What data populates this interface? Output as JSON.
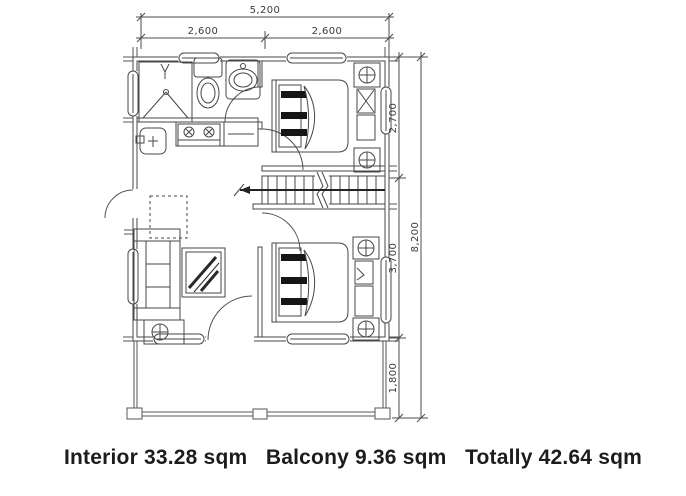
{
  "plan": {
    "dim_top_total": "5,200",
    "dim_top_left": "2,600",
    "dim_top_right": "2,600",
    "dim_right_upper": "2,700",
    "dim_right_middle": "3,700",
    "dim_right_lower": "1,800",
    "dim_right_total": "8,200"
  },
  "footer": {
    "interior": "Interior 33.28 sqm",
    "balcony": "Balcony 9.36 sqm",
    "total": "Totally 42.64 sqm"
  },
  "colors": {
    "line": "#474747",
    "bold": "#1a1a1a",
    "text": "#1c1c1c",
    "background": "#ffffff"
  }
}
